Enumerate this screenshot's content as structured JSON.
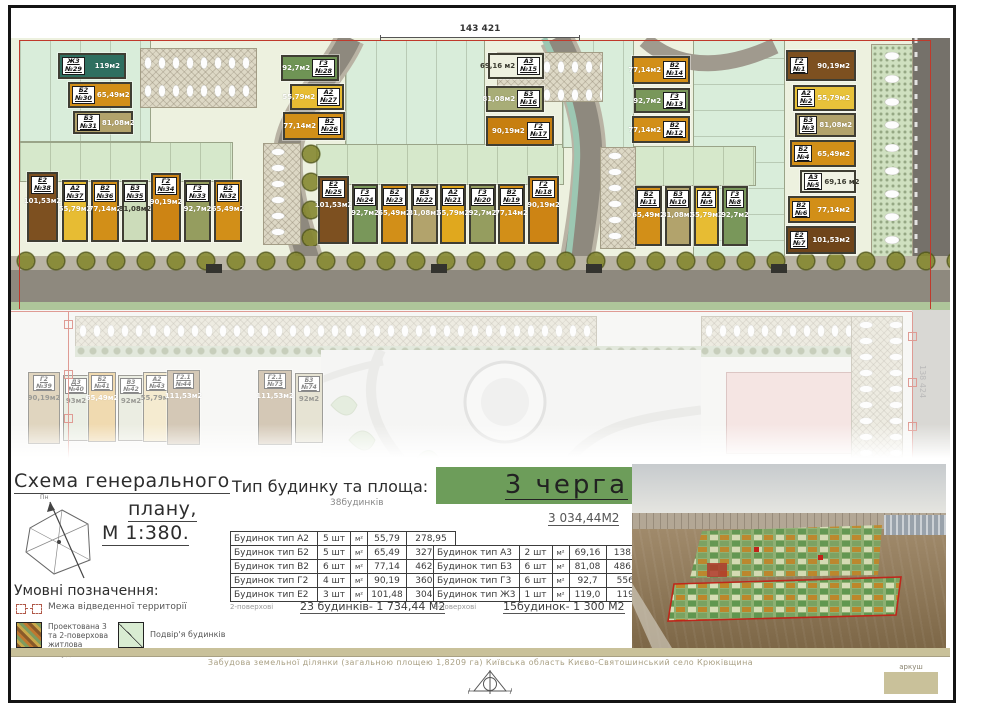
{
  "titles": {
    "scheme_line1": "Схема генерального",
    "scheme_line2": "плану,",
    "scheme_line3": "М 1:380.",
    "legend_heading": "Умовні позначення:",
    "table_heading": "Тип будинку та площа:",
    "table_subheading": "38будинків",
    "phase_title": "3 черга",
    "phase_area": "3 034,44М2"
  },
  "compass": {
    "label": "Пн"
  },
  "dimensions": {
    "top": "143 421",
    "right": "138 424"
  },
  "legend": {
    "items": [
      {
        "label": "Межа відведенної территорії"
      },
      {
        "label": "Проектована 3 та 2-поверхова житлова забудова"
      },
      {
        "label": "Подвір'я будинків"
      }
    ]
  },
  "table2storey": {
    "rows": [
      {
        "name": "Будинок тип А2",
        "qty": "5 шт",
        "unit": "м²",
        "area": "55,79",
        "total": "278,95"
      },
      {
        "name": "Будинок тип Б2",
        "qty": "5 шт",
        "unit": "м²",
        "area": "65,49",
        "total": "327,45"
      },
      {
        "name": "Будинок тип В2",
        "qty": "6 шт",
        "unit": "м²",
        "area": "77,14",
        "total": "462,84"
      },
      {
        "name": "Будинок тип Г2",
        "qty": "4 шт",
        "unit": "м²",
        "area": "90,19",
        "total": "360,76"
      },
      {
        "name": "Будинок тип Е2",
        "qty": "3 шт",
        "unit": "м²",
        "area": "101,48",
        "total": "304,44"
      }
    ],
    "footnote": "2-поверхові",
    "summary": "23 будинків- 1 734,44 М2"
  },
  "table3storey": {
    "rows": [
      {
        "name": "Будинок тип А3",
        "qty": "2 шт",
        "unit": "м²",
        "area": "69,16",
        "total": "138,32"
      },
      {
        "name": "Будинок тип Б3",
        "qty": "6 шт",
        "unit": "м²",
        "area": "81,08",
        "total": "486,48"
      },
      {
        "name": "Будинок тип Г3",
        "qty": "6 шт",
        "unit": "м²",
        "area": "92,7",
        "total": "556,2"
      },
      {
        "name": "Будинок тип Ж3",
        "qty": "1 шт",
        "unit": "м²",
        "area": "119,0",
        "total": "119,0"
      }
    ],
    "footnote": "3-поверхові",
    "summary": "15будинок- 1 300 М2"
  },
  "footer": {
    "description": "Забудова земельної ділянки (загальною площею 1,8209 га) Київська область Києво-Святошинський село Крюківщина",
    "sheet_label": "аркуш"
  },
  "plan": {
    "buildings": [
      {
        "t": "Ж3",
        "n": "№29",
        "a": "119м2",
        "x": 47,
        "y": 15,
        "w": 68,
        "h": 26,
        "c": "#2f6f60",
        "cls": "h"
      },
      {
        "t": "Б2",
        "n": "№30",
        "a": "65,49м2",
        "x": 57,
        "y": 44,
        "w": 64,
        "h": 26,
        "c": "#d28f18",
        "cls": "h"
      },
      {
        "t": "Б3",
        "n": "№31",
        "a": "81,08м2",
        "x": 62,
        "y": 73,
        "w": 60,
        "h": 23,
        "c": "#b2a36c",
        "cls": "h"
      },
      {
        "t": "Е2",
        "n": "№38",
        "a": "101,53м2",
        "x": 16,
        "y": 134,
        "w": 31,
        "h": 70,
        "c": "#7d5020",
        "cls": "v"
      },
      {
        "t": "А2",
        "n": "№37",
        "a": "55,79м2",
        "x": 51,
        "y": 142,
        "w": 26,
        "h": 62,
        "c": "#e7bc33",
        "cls": "v"
      },
      {
        "t": "В2",
        "n": "№36",
        "a": "77,14м2",
        "x": 80,
        "y": 142,
        "w": 28,
        "h": 62,
        "c": "#d28f18",
        "cls": "v"
      },
      {
        "t": "Б3",
        "n": "№35",
        "a": "81,08м2",
        "x": 111,
        "y": 142,
        "w": 26,
        "h": 62,
        "c": "#ccdcba",
        "cls": "v lt"
      },
      {
        "t": "Г2",
        "n": "№34",
        "a": "90,19м2",
        "x": 140,
        "y": 135,
        "w": 30,
        "h": 69,
        "c": "#cd8414",
        "cls": "v"
      },
      {
        "t": "Г3",
        "n": "№33",
        "a": "92,7м2",
        "x": 173,
        "y": 142,
        "w": 27,
        "h": 62,
        "c": "#959d5f",
        "cls": "v"
      },
      {
        "t": "Б2",
        "n": "№32",
        "a": "65,49м2",
        "x": 203,
        "y": 142,
        "w": 28,
        "h": 62,
        "c": "#d28f18",
        "cls": "v"
      },
      {
        "t": "Г3",
        "n": "№28",
        "a": "92,7м2",
        "x": 270,
        "y": 17,
        "w": 58,
        "h": 26,
        "c": "#6f9455",
        "cls": "h rev"
      },
      {
        "t": "А2",
        "n": "№27",
        "a": "55,79м2",
        "x": 279,
        "y": 46,
        "w": 54,
        "h": 26,
        "c": "#e7bc33",
        "cls": "h rev"
      },
      {
        "t": "В2",
        "n": "№26",
        "a": "77,14м2",
        "x": 272,
        "y": 74,
        "w": 62,
        "h": 28,
        "c": "#d28f18",
        "cls": "h rev"
      },
      {
        "t": "Е2",
        "n": "№25",
        "a": "101,53м2",
        "x": 307,
        "y": 138,
        "w": 31,
        "h": 68,
        "c": "#7d5020",
        "cls": "v"
      },
      {
        "t": "Г3",
        "n": "№24",
        "a": "92,7м2",
        "x": 341,
        "y": 146,
        "w": 26,
        "h": 60,
        "c": "#79975a",
        "cls": "v"
      },
      {
        "t": "Б2",
        "n": "№23",
        "a": "65,49м2",
        "x": 370,
        "y": 146,
        "w": 27,
        "h": 60,
        "c": "#d28f18",
        "cls": "v"
      },
      {
        "t": "Б3",
        "n": "№22",
        "a": "81,08м2",
        "x": 400,
        "y": 146,
        "w": 27,
        "h": 60,
        "c": "#b2a36c",
        "cls": "v"
      },
      {
        "t": "А2",
        "n": "№21",
        "a": "55,79м2",
        "x": 429,
        "y": 146,
        "w": 26,
        "h": 60,
        "c": "#e0a81e",
        "cls": "v"
      },
      {
        "t": "Г3",
        "n": "№20",
        "a": "92,7м2",
        "x": 458,
        "y": 146,
        "w": 27,
        "h": 60,
        "c": "#959d5f",
        "cls": "v"
      },
      {
        "t": "В2",
        "n": "№19",
        "a": "77,14м2",
        "x": 487,
        "y": 146,
        "w": 27,
        "h": 60,
        "c": "#d28f18",
        "cls": "v"
      },
      {
        "t": "Г2",
        "n": "№18",
        "a": "90,19м2",
        "x": 517,
        "y": 138,
        "w": 31,
        "h": 68,
        "c": "#cd8414",
        "cls": "v"
      },
      {
        "t": "А3",
        "n": "№15",
        "a": "69,16 м2",
        "x": 477,
        "y": 15,
        "w": 56,
        "h": 26,
        "c": "#eef0e0",
        "cls": "h rev lt"
      },
      {
        "t": "Б3",
        "n": "№16",
        "a": "81,08м2",
        "x": 475,
        "y": 48,
        "w": 58,
        "h": 26,
        "c": "#a8ad77",
        "cls": "h rev"
      },
      {
        "t": "Г2",
        "n": "№17",
        "a": "90,19м2",
        "x": 475,
        "y": 78,
        "w": 68,
        "h": 30,
        "c": "#c77f10",
        "cls": "h rev"
      },
      {
        "t": "В2",
        "n": "№14",
        "a": "77,14м2",
        "x": 621,
        "y": 18,
        "w": 58,
        "h": 28,
        "c": "#d28f18",
        "cls": "h rev"
      },
      {
        "t": "Г3",
        "n": "№13",
        "a": "92,7м2",
        "x": 623,
        "y": 50,
        "w": 56,
        "h": 25,
        "c": "#79975a",
        "cls": "h rev"
      },
      {
        "t": "В2",
        "n": "№12",
        "a": "77,14м2",
        "x": 621,
        "y": 78,
        "w": 58,
        "h": 27,
        "c": "#d28f18",
        "cls": "h rev"
      },
      {
        "t": "Б2",
        "n": "№11",
        "a": "65,49м2",
        "x": 624,
        "y": 148,
        "w": 27,
        "h": 60,
        "c": "#d28f18",
        "cls": "v"
      },
      {
        "t": "Б3",
        "n": "№10",
        "a": "81,08м2",
        "x": 654,
        "y": 148,
        "w": 26,
        "h": 60,
        "c": "#b2a36c",
        "cls": "v"
      },
      {
        "t": "А2",
        "n": "№9",
        "a": "55,79м2",
        "x": 683,
        "y": 148,
        "w": 25,
        "h": 60,
        "c": "#e7bc33",
        "cls": "v"
      },
      {
        "t": "Г3",
        "n": "№8",
        "a": "92,7м2",
        "x": 711,
        "y": 148,
        "w": 26,
        "h": 60,
        "c": "#79975a",
        "cls": "v"
      },
      {
        "t": "Г2",
        "n": "№1",
        "a": "90,19м2",
        "x": 775,
        "y": 12,
        "w": 70,
        "h": 31,
        "c": "#7d5020",
        "cls": "h"
      },
      {
        "t": "А2",
        "n": "№2",
        "a": "55,79м2",
        "x": 782,
        "y": 47,
        "w": 63,
        "h": 26,
        "c": "#e8c23a",
        "cls": "h"
      },
      {
        "t": "Б3",
        "n": "№3",
        "a": "81,08м2",
        "x": 784,
        "y": 75,
        "w": 61,
        "h": 24,
        "c": "#b2a36c",
        "cls": "h"
      },
      {
        "t": "Б2",
        "n": "№4",
        "a": "65,49м2",
        "x": 779,
        "y": 102,
        "w": 66,
        "h": 27,
        "c": "#d28f18",
        "cls": "h"
      },
      {
        "t": "А3",
        "n": "№5",
        "a": "69,16 м2",
        "x": 789,
        "y": 132,
        "w": 56,
        "h": 23,
        "c": "#f0f2e4",
        "cls": "h lt"
      },
      {
        "t": "В2",
        "n": "№6",
        "a": "77,14м2",
        "x": 777,
        "y": 158,
        "w": 68,
        "h": 27,
        "c": "#d28f18",
        "cls": "h"
      },
      {
        "t": "Е2",
        "n": "№7",
        "a": "101,53м2",
        "x": 775,
        "y": 188,
        "w": 70,
        "h": 28,
        "c": "#6f451a",
        "cls": "h"
      }
    ],
    "faded_buildings": [
      {
        "t": "Г2",
        "n": "№39",
        "a": "90,19м2",
        "x": 17,
        "y": 62,
        "w": 32,
        "h": 72,
        "c": "#c2ad80",
        "cls": "v fade lt"
      },
      {
        "t": "Д3",
        "n": "№40",
        "a": "93м2",
        "x": 52,
        "y": 65,
        "w": 26,
        "h": 66,
        "c": "#d8e0cc",
        "cls": "v fade lt"
      },
      {
        "t": "Б2",
        "n": "№41",
        "a": "65,49м2",
        "x": 77,
        "y": 62,
        "w": 28,
        "h": 70,
        "c": "#e3b763",
        "cls": "v fade"
      },
      {
        "t": "В3",
        "n": "№42",
        "a": "92м2",
        "x": 107,
        "y": 65,
        "w": 26,
        "h": 66,
        "c": "#d9dcc6",
        "cls": "v fade lt"
      },
      {
        "t": "А2",
        "n": "№43",
        "a": "55,79м2",
        "x": 132,
        "y": 62,
        "w": 28,
        "h": 70,
        "c": "#ecd9a2",
        "cls": "v fade lt"
      },
      {
        "t": "Г2.1",
        "n": "№44",
        "a": "111,53м2",
        "x": 156,
        "y": 60,
        "w": 33,
        "h": 75,
        "c": "#ab9370",
        "cls": "v fade"
      },
      {
        "t": "Г2.1",
        "n": "№73",
        "a": "111,53м2",
        "x": 247,
        "y": 60,
        "w": 34,
        "h": 75,
        "c": "#ab9370",
        "cls": "v fade"
      },
      {
        "t": "Б3",
        "n": "№74",
        "a": "92м2",
        "x": 284,
        "y": 63,
        "w": 28,
        "h": 70,
        "c": "#cfc9a8",
        "cls": "v fade lt"
      }
    ]
  },
  "colors": {
    "phase_banner": "#6d9d5a",
    "boundary_red": "#c0392b",
    "khaki_bar": "#c9c19a"
  }
}
